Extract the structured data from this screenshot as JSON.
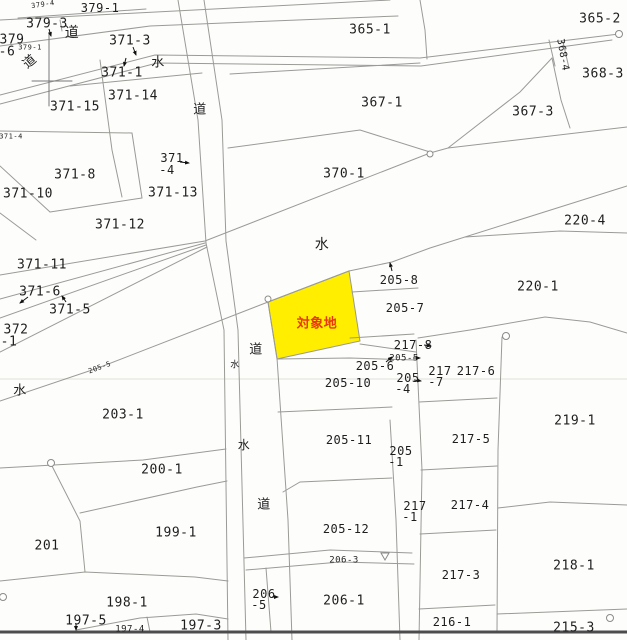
{
  "map": {
    "type": "cadastral-parcel-map",
    "background_color": "#fdfdfc",
    "boundary_line_color": "#9a9a96",
    "subject_parcel": {
      "label": "対象地",
      "label_color": "#e8380d",
      "fill": "#ffee00"
    },
    "legend": {
      "road_char": "道",
      "water_char": "水"
    },
    "labels": [
      {
        "t": "379-4",
        "x": 43,
        "y": 5,
        "s": 7,
        "r": -8
      },
      {
        "t": "379-1",
        "x": 100,
        "y": 8,
        "s": 12
      },
      {
        "t": "379-3",
        "x": 47,
        "y": 24,
        "s": 13
      },
      {
        "t": "道",
        "x": 72,
        "y": 33,
        "s": 14,
        "n": "road-label"
      },
      {
        "t": "379",
        "x": 12,
        "y": 40,
        "s": 13
      },
      {
        "t": "-6",
        "x": 7,
        "y": 52,
        "s": 13
      },
      {
        "t": "379-1",
        "x": 30,
        "y": 48,
        "s": 7
      },
      {
        "t": "道",
        "x": 30,
        "y": 62,
        "s": 13,
        "r": -40,
        "n": "road-label"
      },
      {
        "t": "371-3",
        "x": 130,
        "y": 41,
        "s": 13
      },
      {
        "t": "水",
        "x": 158,
        "y": 63,
        "s": 13,
        "n": "water-label"
      },
      {
        "t": "371-1",
        "x": 122,
        "y": 73,
        "s": 13
      },
      {
        "t": "371-14",
        "x": 133,
        "y": 96,
        "s": 13
      },
      {
        "t": "371-15",
        "x": 75,
        "y": 107,
        "s": 13
      },
      {
        "t": "道",
        "x": 200,
        "y": 110,
        "s": 13,
        "n": "road-label"
      },
      {
        "t": "365-1",
        "x": 370,
        "y": 30,
        "s": 13
      },
      {
        "t": "365-2",
        "x": 600,
        "y": 19,
        "s": 13
      },
      {
        "t": "368-4",
        "x": 562,
        "y": 55,
        "s": 10,
        "r": 80
      },
      {
        "t": "368-3",
        "x": 603,
        "y": 74,
        "s": 13
      },
      {
        "t": "367-1",
        "x": 382,
        "y": 103,
        "s": 13
      },
      {
        "t": "367-3",
        "x": 533,
        "y": 112,
        "s": 13
      },
      {
        "t": "371-4",
        "x": 11,
        "y": 137,
        "s": 7
      },
      {
        "t": "371",
        "x": 172,
        "y": 158,
        "s": 12
      },
      {
        "t": "-4",
        "x": 167,
        "y": 170,
        "s": 12
      },
      {
        "t": "371-8",
        "x": 75,
        "y": 175,
        "s": 13
      },
      {
        "t": "371-13",
        "x": 173,
        "y": 193,
        "s": 13
      },
      {
        "t": "371-10",
        "x": 28,
        "y": 194,
        "s": 13
      },
      {
        "t": "371-12",
        "x": 120,
        "y": 225,
        "s": 13
      },
      {
        "t": "370-1",
        "x": 344,
        "y": 174,
        "s": 13
      },
      {
        "t": "水",
        "x": 322,
        "y": 245,
        "s": 14,
        "n": "water-label"
      },
      {
        "t": "220-4",
        "x": 585,
        "y": 221,
        "s": 13
      },
      {
        "t": "371-11",
        "x": 42,
        "y": 265,
        "s": 13
      },
      {
        "t": "371-6",
        "x": 40,
        "y": 292,
        "s": 13
      },
      {
        "t": "371-5",
        "x": 70,
        "y": 310,
        "s": 13
      },
      {
        "t": "372",
        "x": 16,
        "y": 330,
        "s": 13
      },
      {
        "t": "-1",
        "x": 9,
        "y": 342,
        "s": 13
      },
      {
        "t": "220-1",
        "x": 538,
        "y": 287,
        "s": 13
      },
      {
        "t": "205-8",
        "x": 399,
        "y": 280,
        "s": 12
      },
      {
        "t": "205-7",
        "x": 405,
        "y": 308,
        "s": 12
      },
      {
        "t": "対象地",
        "x": 317,
        "y": 324,
        "s": 13,
        "c": "#e8380d",
        "b": 1,
        "n": "subject-site-label"
      },
      {
        "t": "道",
        "x": 256,
        "y": 350,
        "s": 13,
        "n": "road-label"
      },
      {
        "t": "水",
        "x": 235,
        "y": 366,
        "s": 9,
        "n": "water-label"
      },
      {
        "t": "217-8",
        "x": 413,
        "y": 345,
        "s": 12
      },
      {
        "t": "205-5",
        "x": 404,
        "y": 359,
        "s": 9
      },
      {
        "t": "205-6",
        "x": 375,
        "y": 366,
        "s": 12
      },
      {
        "t": "217",
        "x": 440,
        "y": 371,
        "s": 12
      },
      {
        "t": "-7",
        "x": 436,
        "y": 382,
        "s": 12
      },
      {
        "t": "217-6",
        "x": 476,
        "y": 371,
        "s": 12
      },
      {
        "t": "205",
        "x": 408,
        "y": 378,
        "s": 12
      },
      {
        "t": "-4",
        "x": 403,
        "y": 389,
        "s": 12
      },
      {
        "t": "205-10",
        "x": 348,
        "y": 383,
        "s": 12
      },
      {
        "t": "水",
        "x": 20,
        "y": 391,
        "s": 13,
        "n": "water-label"
      },
      {
        "t": "205-5",
        "x": 100,
        "y": 368,
        "s": 7,
        "r": -20
      },
      {
        "t": "203-1",
        "x": 123,
        "y": 415,
        "s": 13
      },
      {
        "t": "219-1",
        "x": 575,
        "y": 421,
        "s": 13
      },
      {
        "t": "205-11",
        "x": 349,
        "y": 440,
        "s": 12
      },
      {
        "t": "217-5",
        "x": 471,
        "y": 439,
        "s": 12
      },
      {
        "t": "205",
        "x": 401,
        "y": 451,
        "s": 12
      },
      {
        "t": "-1",
        "x": 396,
        "y": 462,
        "s": 12
      },
      {
        "t": "水",
        "x": 244,
        "y": 445,
        "s": 12,
        "n": "water-label"
      },
      {
        "t": "200-1",
        "x": 162,
        "y": 470,
        "s": 13
      },
      {
        "t": "217",
        "x": 415,
        "y": 506,
        "s": 12
      },
      {
        "t": "-1",
        "x": 410,
        "y": 517,
        "s": 12
      },
      {
        "t": "217-4",
        "x": 470,
        "y": 505,
        "s": 12
      },
      {
        "t": "道",
        "x": 264,
        "y": 505,
        "s": 13,
        "n": "road-label"
      },
      {
        "t": "201",
        "x": 47,
        "y": 546,
        "s": 13
      },
      {
        "t": "199-1",
        "x": 176,
        "y": 533,
        "s": 13
      },
      {
        "t": "205-12",
        "x": 346,
        "y": 529,
        "s": 12
      },
      {
        "t": "206-3",
        "x": 344,
        "y": 561,
        "s": 9
      },
      {
        "t": "217-3",
        "x": 461,
        "y": 575,
        "s": 12
      },
      {
        "t": "218-1",
        "x": 574,
        "y": 566,
        "s": 13
      },
      {
        "t": "198-1",
        "x": 127,
        "y": 603,
        "s": 13
      },
      {
        "t": "197-5",
        "x": 86,
        "y": 621,
        "s": 13
      },
      {
        "t": "206",
        "x": 264,
        "y": 594,
        "s": 12
      },
      {
        "t": "-5",
        "x": 259,
        "y": 605,
        "s": 12
      },
      {
        "t": "206-1",
        "x": 344,
        "y": 601,
        "s": 13
      },
      {
        "t": "197-4",
        "x": 130,
        "y": 630,
        "s": 9
      },
      {
        "t": "197-3",
        "x": 201,
        "y": 626,
        "s": 13
      },
      {
        "t": "216-1",
        "x": 452,
        "y": 622,
        "s": 12
      },
      {
        "t": "215-3",
        "x": 574,
        "y": 628,
        "s": 13
      }
    ]
  }
}
